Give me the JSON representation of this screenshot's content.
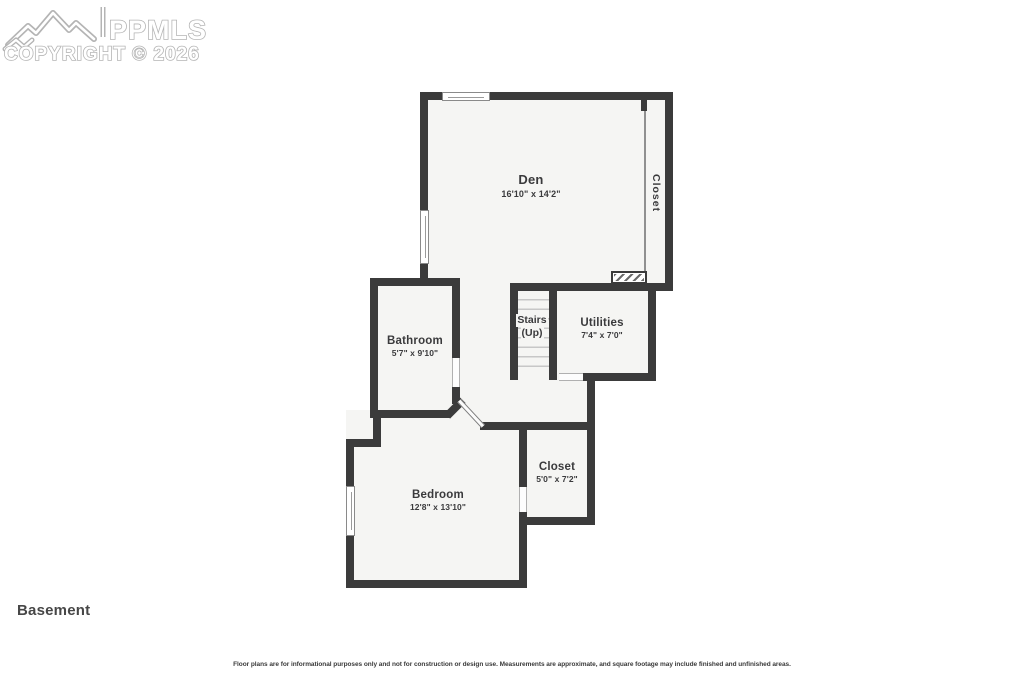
{
  "watermark": {
    "brand": "PPMLS",
    "copyright_line": "COPYRIGHT © 2026"
  },
  "plan": {
    "rooms": {
      "den": {
        "name": "Den",
        "dims": "16'10\" x 14'2\""
      },
      "closet_upper": {
        "name": "Closet"
      },
      "bathroom": {
        "name": "Bathroom",
        "dims": "5'7\" x 9'10\""
      },
      "stairs": {
        "name": "Stairs",
        "direction": "(Up)"
      },
      "utilities": {
        "name": "Utilities",
        "dims": "7'4\" x 7'0\""
      },
      "bedroom": {
        "name": "Bedroom",
        "dims": "12'8\" x 13'10\""
      },
      "closet_lower": {
        "name": "Closet",
        "dims": "5'0\" x 7'2\""
      }
    }
  },
  "footer": {
    "floor_label": "Basement",
    "disclaimer": "Floor plans are for informational purposes only and not for construction or design use. Measurements are approximate, and square footage may include finished and unfinished areas."
  },
  "colors": {
    "wall": "#3b3b3b",
    "floor": "#f5f5f3",
    "label_text": "#3a3a3c",
    "watermark_outline": "#b4b4b4"
  }
}
